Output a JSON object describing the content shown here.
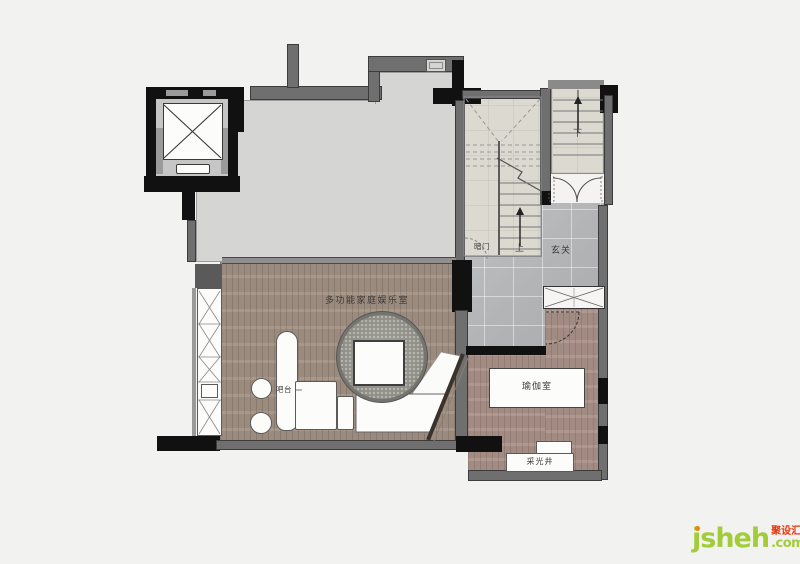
{
  "labels": {
    "entertainment_room": "多功能家庭娱乐室",
    "bar": "吧台",
    "yoga_room": "瑜伽室",
    "foyer": "玄关",
    "hidden_door": "暗门",
    "stairs_up": "上",
    "stairs_down": "下",
    "light_well": "采光井"
  },
  "watermark": {
    "brand": "jsheh",
    "suffix": ".com",
    "cjk": "聚设汇"
  },
  "colors": {
    "bg": "#f2f2f1",
    "wall-black": "#111111",
    "wall-gray": "#6f6f6f",
    "toproom-floor": "#d5d5d4",
    "stair-floor": "#dcd9d1",
    "marble": "#b6b7b9",
    "wood-main": "#a39285",
    "wood-yoga": "#ab9289",
    "furniture": "#fcfcfb",
    "rug": "#98988f",
    "label": "#3c3b39",
    "wm-green": "#a3cc39",
    "wm-red": "#e8380d",
    "wm-orange": "#f08300"
  }
}
